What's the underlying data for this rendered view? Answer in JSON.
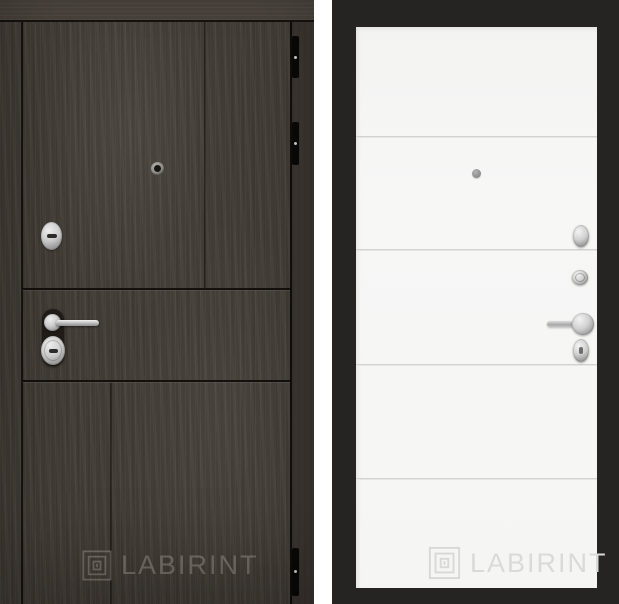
{
  "page": {
    "background_color": "#ffffff"
  },
  "product_image": {
    "description": "Entry door product photo shown from both sides",
    "left_panel": {
      "side_label": "dark woodgrain exterior side",
      "brand": "LABIRINT",
      "hardware": [
        "peephole",
        "lock-escutcheon",
        "door-handle-lever",
        "lock-cylinder",
        "hinge",
        "hinge",
        "hinge"
      ],
      "colors": {
        "wood": "#433d37",
        "wood_top_rail": "#48423b",
        "groove_line": "#14100d",
        "edge_strip": "#3b3531",
        "hinge": "#0b0908",
        "watermark": "rgba(224,218,209,0.30)"
      }
    },
    "right_panel": {
      "side_label": "white interior side with black frame",
      "brand": "LABIRINT",
      "hardware": [
        "peephole",
        "thumb-turn",
        "lock-cylinder",
        "door-handle-lever",
        "lock-escutcheon"
      ],
      "colors": {
        "frame": "#262323",
        "panel": "#f6f6f5",
        "groove_line": "#d2d2d0",
        "watermark": "#dadad8"
      }
    },
    "hardware_chrome_color": "#c9c9c9"
  }
}
